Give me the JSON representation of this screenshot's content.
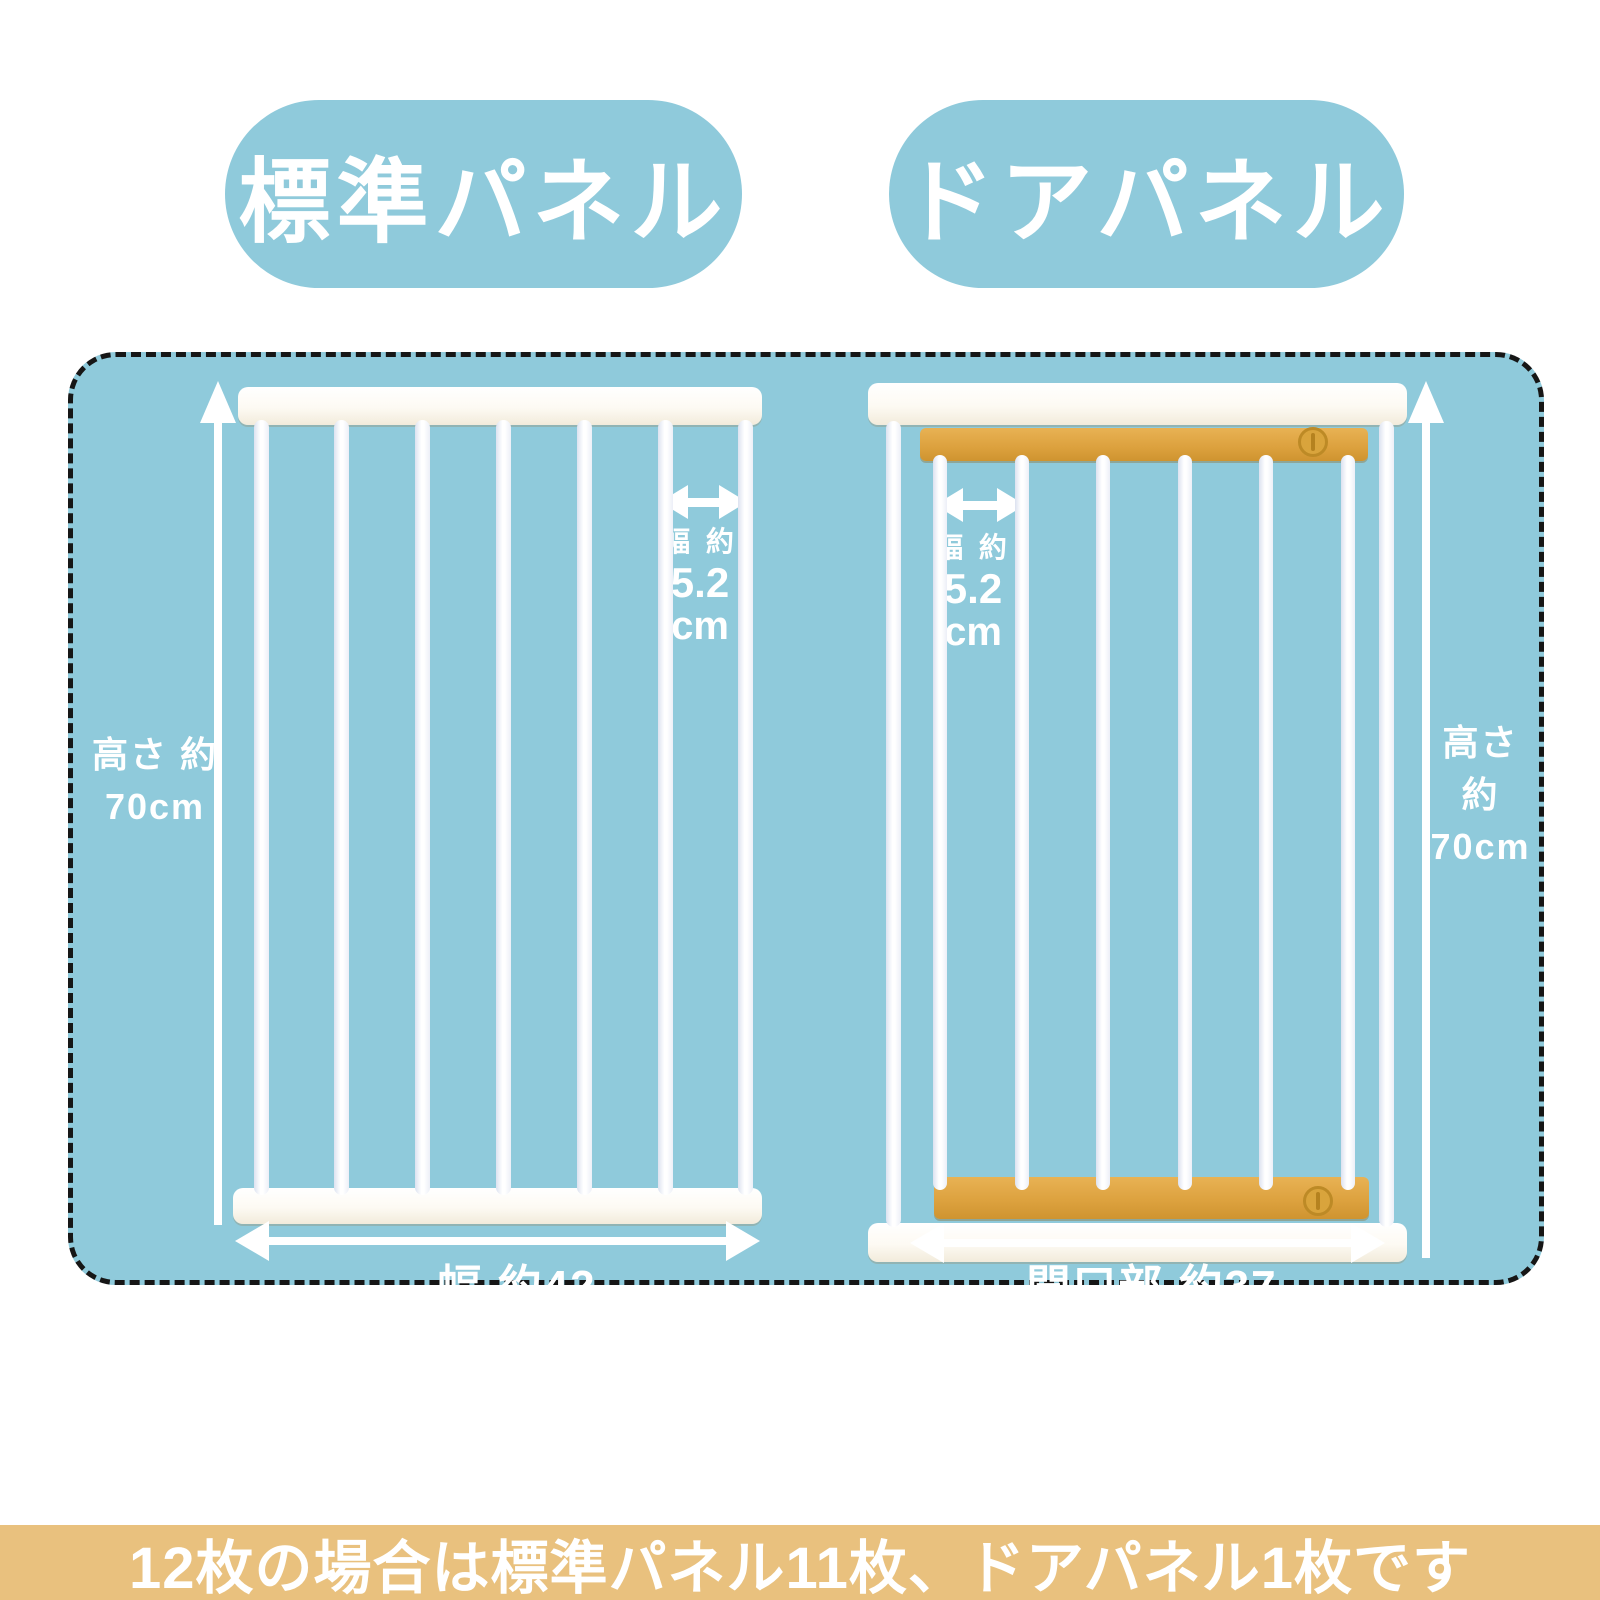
{
  "colors": {
    "background": "#ffffff",
    "panel_blue": "#8fcadb",
    "gate_white": "#ffffff",
    "door_yellow": "#dda23f",
    "banner_tan": "#e9c17e",
    "dashed_border": "#161616",
    "text": "#ffffff"
  },
  "labels": {
    "standard_panel": "標準パネル",
    "door_panel": "ドアパネル"
  },
  "standard_panel": {
    "bar_count": 7,
    "height_label_line1": "高さ 約",
    "height_label_line2": "70cm",
    "bar_gap_label_line1": "幅 約",
    "bar_gap_label_line2": "5.2",
    "bar_gap_label_line3": "cm",
    "width_label": "幅 約42"
  },
  "door_panel": {
    "frame_bar_count": 2,
    "door_bar_count": 6,
    "height_label_line1": "高さ 約",
    "height_label_line2": "70cm",
    "bar_gap_label_line1": "幅 約",
    "bar_gap_label_line2": "5.2",
    "bar_gap_label_line3": "cm",
    "opening_label": "開口部 約37"
  },
  "footer": {
    "text": "12枚の場合は標準パネル11枚、ドアパネル1枚です"
  }
}
